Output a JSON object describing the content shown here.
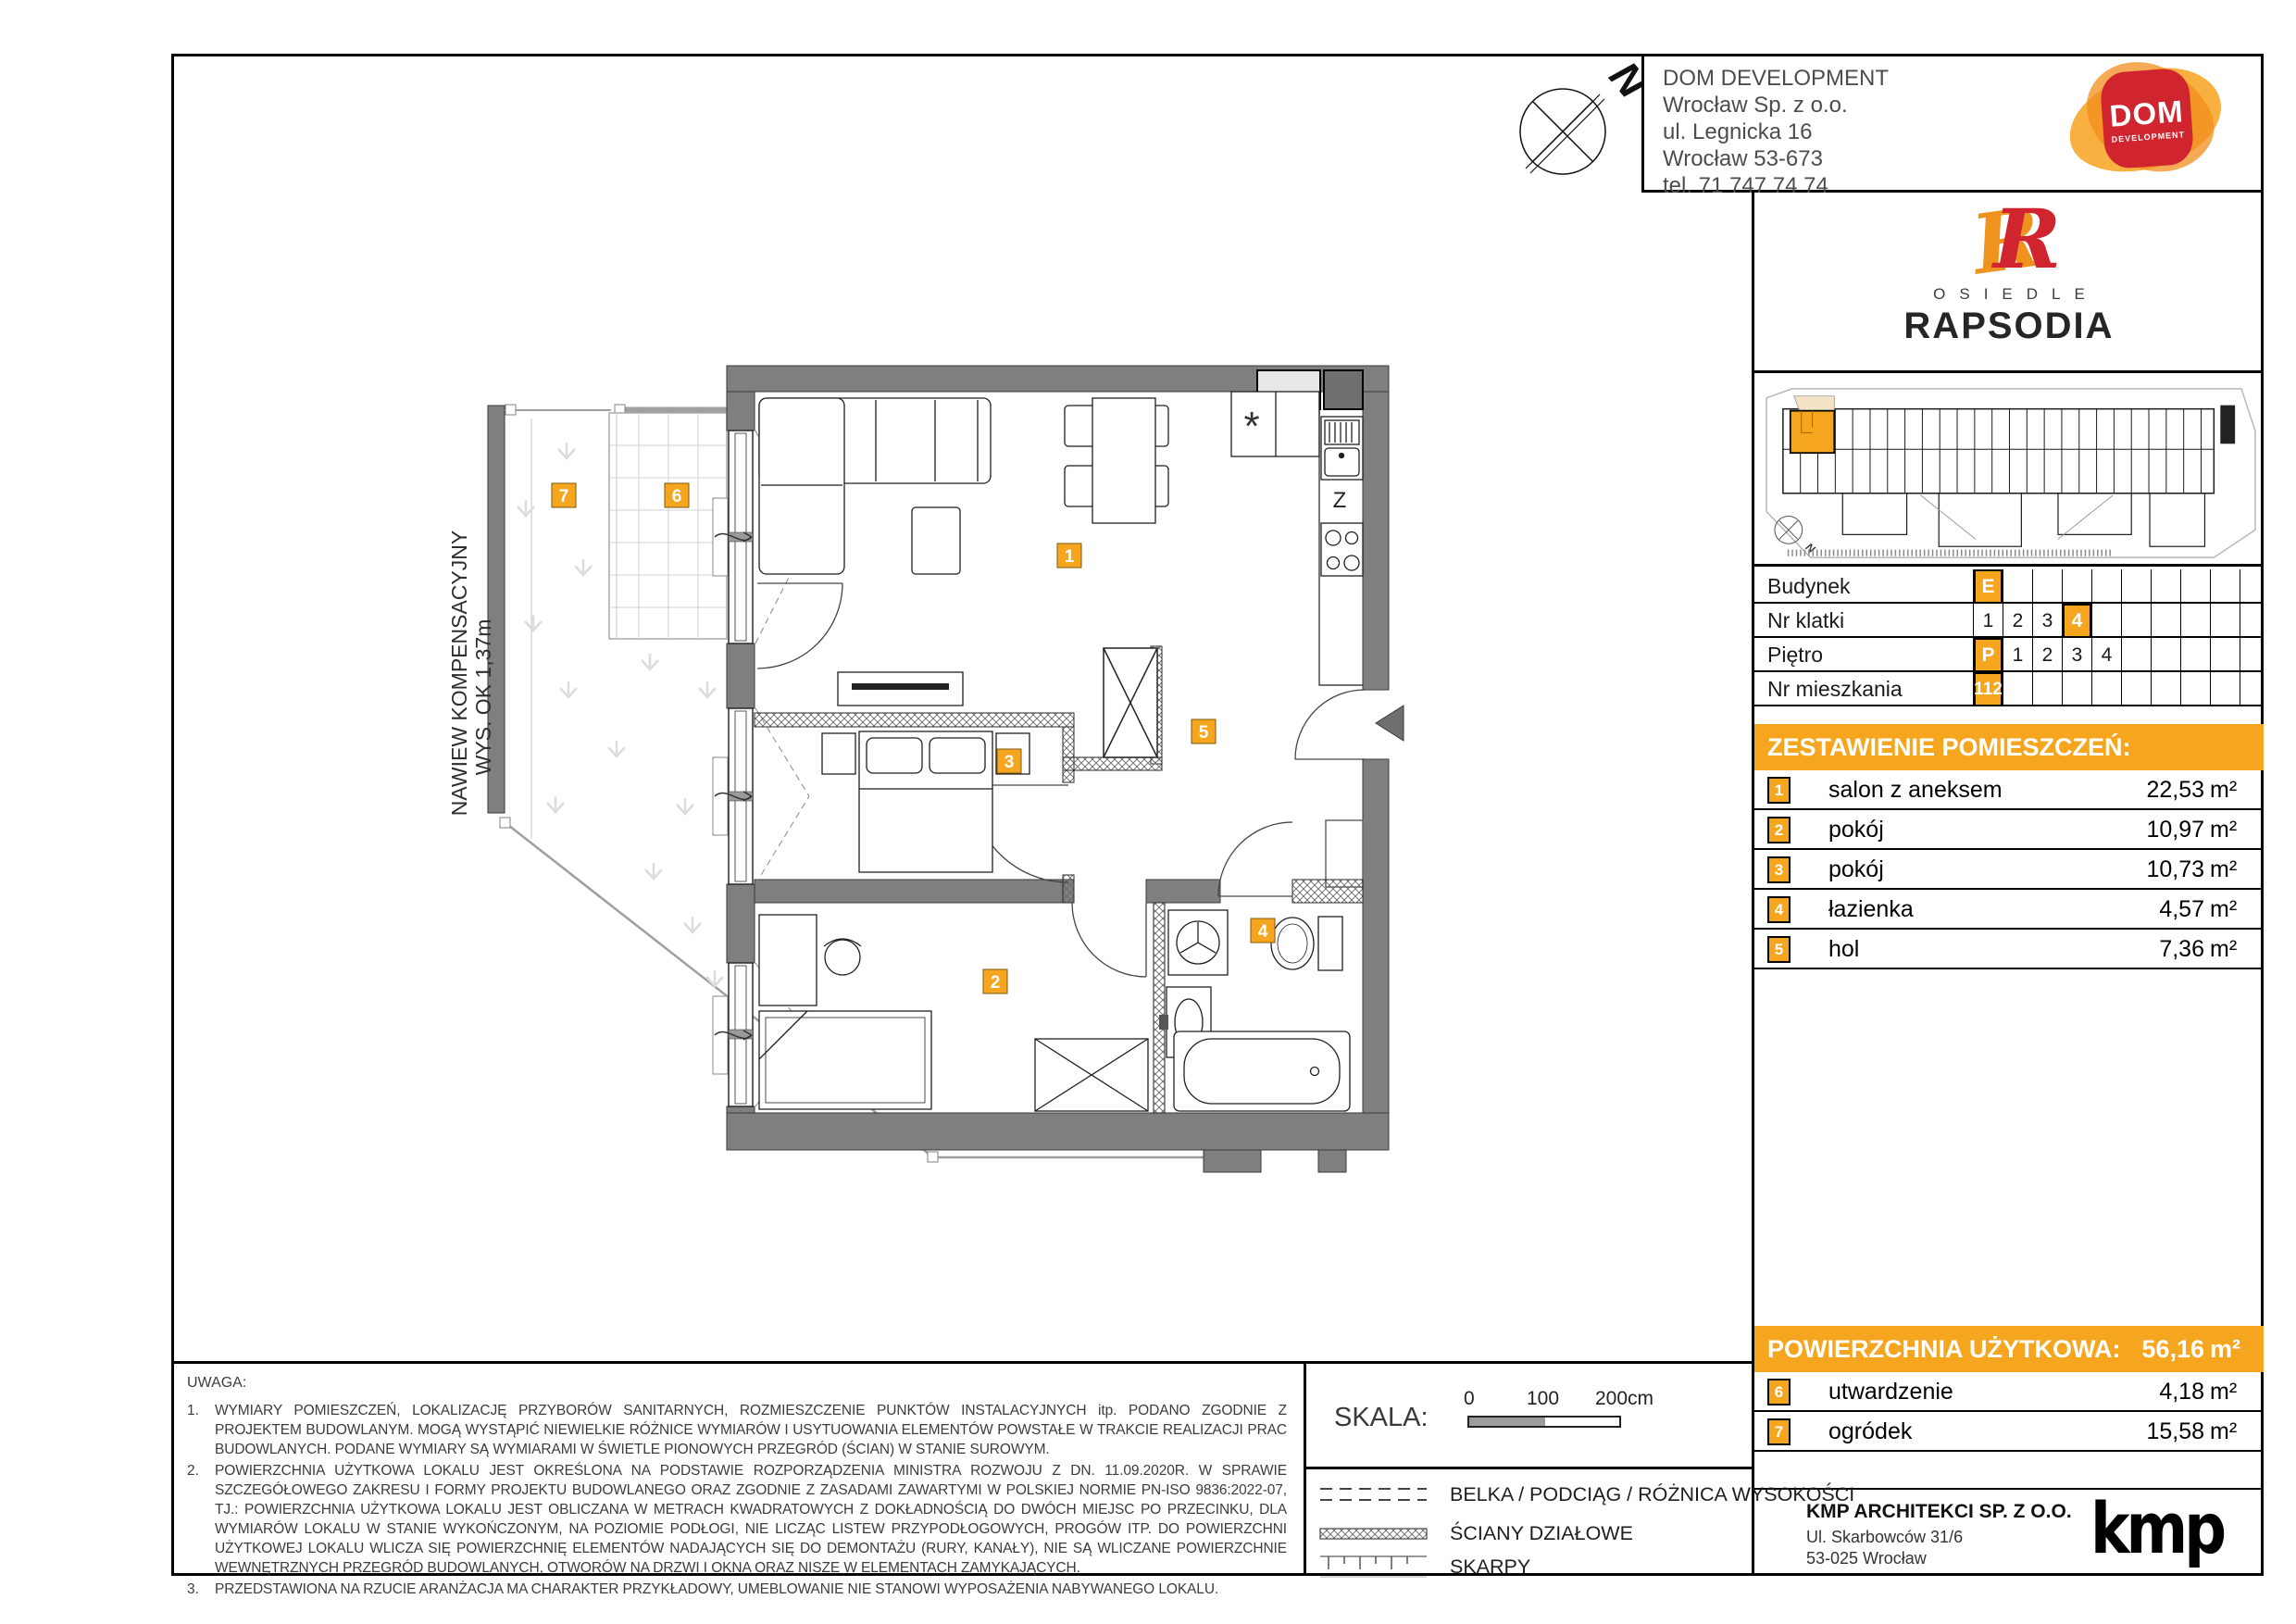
{
  "header": {
    "company_lines": [
      "DOM DEVELOPMENT",
      "Wrocław Sp. z o.o.",
      "ul. Legnicka 16",
      "Wrocław 53-673",
      "tel. 71 747 74 74"
    ],
    "logo_title": "DOM",
    "logo_subtitle": "DEVELOPMENT"
  },
  "estate": {
    "kicker": "OSIEDLE",
    "name": "RAPSODIA",
    "monogram": "R"
  },
  "siteplan": {
    "north": "N"
  },
  "compass": {
    "north": "N"
  },
  "plan": {
    "nawiew_line1": "NAWIEW KOMPENSACYJNY",
    "nawiew_line2": "WYS. OK 1,37m",
    "badges": [
      "1",
      "2",
      "3",
      "4",
      "5",
      "6",
      "7"
    ],
    "kitchen": {
      "appliance_symbol": "*",
      "sink_symbol": "Z"
    }
  },
  "unit_info": {
    "rows": [
      {
        "label": "Budynek",
        "cells": [
          "E",
          "",
          "",
          "",
          "",
          "",
          "",
          "",
          ""
        ]
      },
      {
        "label": "Nr klatki",
        "cells": [
          "1",
          "2",
          "3",
          "4",
          "",
          "",
          "",
          "",
          ""
        ]
      },
      {
        "label": "Piętro",
        "cells": [
          "P",
          "1",
          "2",
          "3",
          "4",
          "",
          "",
          "",
          ""
        ]
      },
      {
        "label": "Nr mieszkania",
        "cells": [
          "112",
          "",
          "",
          "",
          "",
          "",
          "",
          "",
          ""
        ]
      }
    ]
  },
  "rooms": {
    "title": "ZESTAWIENIE POMIESZCZEŃ:",
    "rows": [
      {
        "no": "1",
        "name": "salon z aneksem",
        "area": "22,53",
        "unit": "m²"
      },
      {
        "no": "2",
        "name": "pokój",
        "area": "10,97",
        "unit": "m²"
      },
      {
        "no": "3",
        "name": "pokój",
        "area": "10,73",
        "unit": "m²"
      },
      {
        "no": "4",
        "name": "łazienka",
        "area": "4,57",
        "unit": "m²"
      },
      {
        "no": "5",
        "name": "hol",
        "area": "7,36",
        "unit": "m²"
      }
    ]
  },
  "summary": {
    "label": "POWIERZCHNIA UŻYTKOWA:",
    "area": "56,16",
    "unit": "m²",
    "extra_rows": [
      {
        "no": "6",
        "name": "utwardzenie",
        "area": "4,18",
        "unit": "m²"
      },
      {
        "no": "7",
        "name": "ogródek",
        "area": "15,58",
        "unit": "m²"
      }
    ]
  },
  "architect": {
    "name": "KMP ARCHITEKCI SP. Z O.O.",
    "address_line1": "Ul. Skarbowców 31/6",
    "address_line2": "53-025 Wrocław",
    "logo": "kmp"
  },
  "notes": {
    "heading": "UWAGA:",
    "items": [
      {
        "no": "1.",
        "text": "WYMIARY POMIESZCZEŃ, LOKALIZACJĘ PRZYBORÓW SANITARNYCH, ROZMIESZCZENIE PUNKTÓW INSTALACYJNYCH itp. PODANO ZGODNIE Z PROJEKTEM BUDOWLANYM. MOGĄ WYSTĄPIĆ NIEWIELKIE RÓŻNICE WYMIARÓW I USYTUOWANIA ELEMENTÓW POWSTAŁE W TRAKCIE REALIZACJI PRAC BUDOWLANYCH. PODANE WYMIARY SĄ WYMIARAMI W ŚWIETLE PIONOWYCH PRZEGRÓD (ŚCIAN) W STANIE SUROWYM."
      },
      {
        "no": "2.",
        "text": "POWIERZCHNIA UŻYTKOWA LOKALU JEST OKREŚLONA NA PODSTAWIE ROZPORZĄDZENIA MINISTRA ROZWOJU Z DN. 11.09.2020R. W SPRAWIE SZCZEGÓŁOWEGO ZAKRESU I FORMY PROJEKTU BUDOWLANEGO ORAZ ZGODNIE Z ZASADAMI ZAWARTYMI W POLSKIEJ NORMIE PN-ISO 9836:2022-07, TJ.: POWIERZCHNIA UŻYTKOWA LOKALU JEST OBLICZANA W METRACH KWADRATOWYCH Z DOKŁADNOŚCIĄ DO DWÓCH MIEJSC PO PRZECINKU, DLA WYMIARÓW LOKALU W STANIE WYKOŃCZONYM, NA POZIOMIE PODŁOGI, NIE LICZĄC LISTEW PRZYPODŁOGOWYCH, PROGÓW ITP. DO POWIERZCHNI UŻYTKOWEJ LOKALU WLICZA SIĘ POWIERZCHNIĘ ELEMENTÓW NADAJĄCYCH SIĘ DO DEMONTAŻU (RURY, KANAŁY), NIE SĄ WLICZANE POWIERZCHNIE WEWNĘTRZNYCH PRZEGRÓD BUDOWLANYCH, OTWORÓW NA DRZWI I OKNA ORAZ NISZE W ELEMENTACH ZAMYKAJĄCYCH."
      },
      {
        "no": "3.",
        "text": "PRZEDSTAWIONA NA RZUCIE ARANŻACJA MA CHARAKTER PRZYKŁADOWY, UMEBLOWANIE NIE STANOWI WYPOSAŻENIA NABYWANEGO LOKALU."
      }
    ]
  },
  "scale": {
    "label": "SKALA:",
    "tick0": "0",
    "tick100": "100",
    "tick200": "200cm"
  },
  "legend": {
    "items": [
      "BELKA / PODCIĄG / RÓŻNICA WYSOKOŚCI",
      "ŚCIANY DZIAŁOWE",
      "SKARPY"
    ]
  },
  "colors": {
    "accent": "#F6A51F",
    "wall": "#7f7f7f",
    "logo_red": "#D0242E",
    "logo_orange": "#F28D1E",
    "beige": "#F3E2C3"
  }
}
